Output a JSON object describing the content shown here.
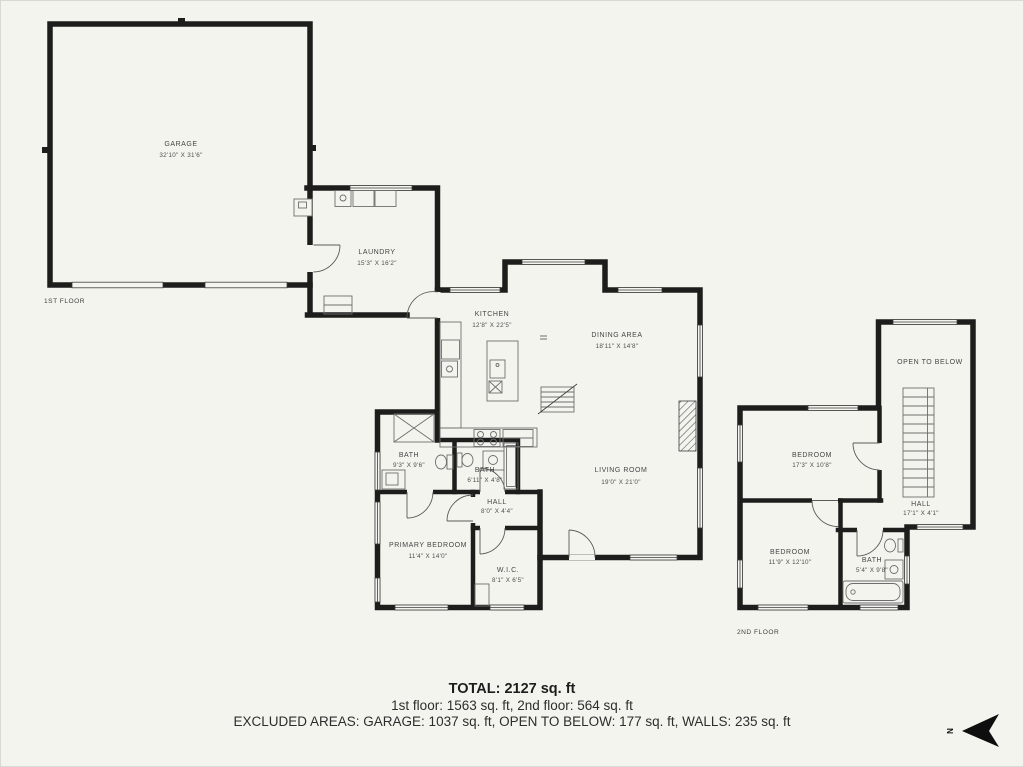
{
  "colors": {
    "background": "#f4f4ef",
    "wall": "#1d1d1b"
  },
  "floors": {
    "first": {
      "tag": "1ST FLOOR",
      "rooms": {
        "garage": {
          "name": "GARAGE",
          "dims": "32'10\" X 31'6\""
        },
        "laundry": {
          "name": "LAUNDRY",
          "dims": "15'3\" X 16'2\""
        },
        "kitchen": {
          "name": "KITCHEN",
          "dims": "12'8\" X 22'5\""
        },
        "dining": {
          "name": "DINING AREA",
          "dims": "18'11\" X 14'8\""
        },
        "living": {
          "name": "LIVING ROOM",
          "dims": "19'0\" X 21'0\""
        },
        "bath1": {
          "name": "BATH",
          "dims": "9'3\" X 9'6\""
        },
        "bath2": {
          "name": "BATH",
          "dims": "6'11\" X 4'8\""
        },
        "hall": {
          "name": "HALL",
          "dims": "8'0\" X 4'4\""
        },
        "primary_bedroom": {
          "name": "PRIMARY BEDROOM",
          "dims": "11'4\" X 14'0\""
        },
        "wic": {
          "name": "W.I.C.",
          "dims": "8'1\" X 6'5\""
        }
      }
    },
    "second": {
      "tag": "2ND FLOOR",
      "rooms": {
        "open_to_below": {
          "name": "OPEN TO BELOW",
          "dims": ""
        },
        "bedroom1": {
          "name": "BEDROOM",
          "dims": "17'3\" X 10'8\""
        },
        "hall2": {
          "name": "HALL",
          "dims": "17'1\" X 4'1\""
        },
        "bedroom2": {
          "name": "BEDROOM",
          "dims": "11'9\" X 12'10\""
        },
        "bath3": {
          "name": "BATH",
          "dims": "5'4\" X 9'8\""
        }
      }
    }
  },
  "summary": {
    "total": "TOTAL: 2127 sq. ft",
    "floors_line": "1st floor: 1563 sq. ft, 2nd floor: 564 sq. ft",
    "excluded_line": "EXCLUDED AREAS: GARAGE: 1037 sq. ft, OPEN TO BELOW: 177 sq. ft, WALLS: 235 sq. ft"
  },
  "compass": {
    "label": "N"
  }
}
